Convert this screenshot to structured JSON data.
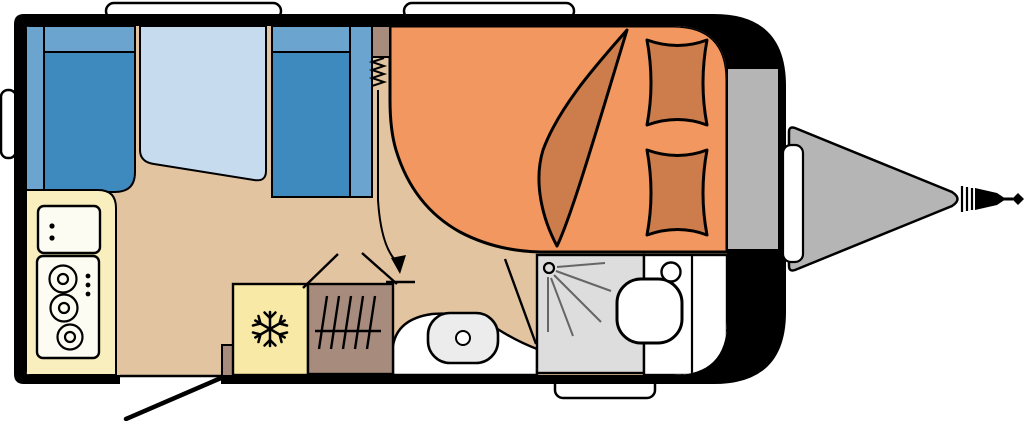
{
  "diagram": {
    "type": "caravan-floorplan",
    "view": "top-down",
    "hitch_side": "right",
    "areas": [
      {
        "name": "dinette",
        "items": [
          "left-bench",
          "table",
          "right-bench"
        ]
      },
      {
        "name": "kitchen",
        "items": [
          "counter",
          "sink",
          "three-burner-stove"
        ]
      },
      {
        "name": "mid-cabinets",
        "items": [
          "fridge",
          "wardrobe-heater",
          "entry-door",
          "step"
        ]
      },
      {
        "name": "washroom",
        "items": [
          "washbasin",
          "shower",
          "toilet"
        ]
      },
      {
        "name": "bedroom",
        "items": [
          "double-bed",
          "blanket",
          "pillow",
          "pillow"
        ]
      },
      {
        "name": "front",
        "items": [
          "gas-locker",
          "drawbar",
          "coupling-hitch"
        ]
      }
    ],
    "windows": [
      "top-left-window",
      "top-right-window",
      "rear-left-window",
      "bottom-service-hatch",
      "front-right-hatch"
    ]
  },
  "colors": {
    "body": "#000000",
    "floor": "#e3c4a1",
    "seat": "#3e89be",
    "seatLight": "#6ba4cf",
    "table": "#c7dbee",
    "counter": "#f9efbe",
    "appliance": "#fdfcf3",
    "fridge": "#f8e9a6",
    "wood": "#a78c7d",
    "bed": "#f1975f",
    "bedding": "#cd7c4c",
    "shower": "#dddddd",
    "basin": "#ececec",
    "gray": "#b5b5b5",
    "white": "#ffffff",
    "line": "#000000",
    "spray": "#666666"
  }
}
